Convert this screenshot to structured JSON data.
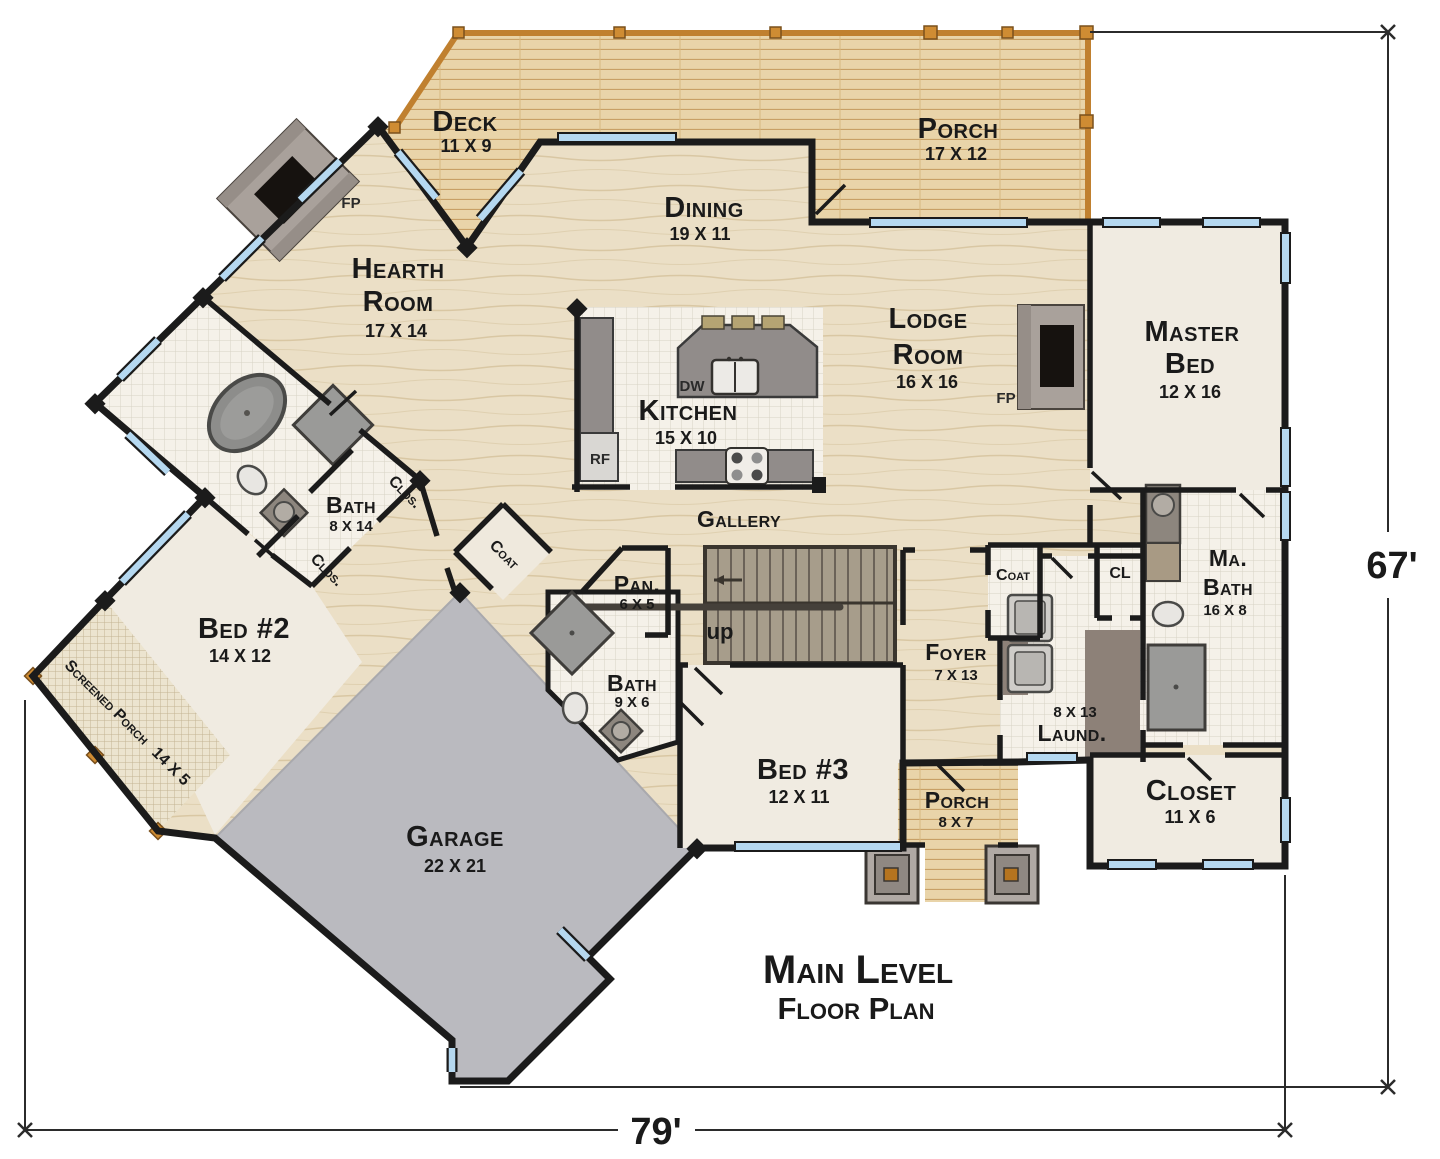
{
  "plan": {
    "title": {
      "line1": "Main Level",
      "line2": "Floor Plan"
    },
    "dimensions": {
      "width": "79'",
      "height": "67'"
    },
    "rooms": {
      "deck": {
        "name": "Deck",
        "size": "11 X 9"
      },
      "porch_top": {
        "name": "Porch",
        "size": "17 X 12"
      },
      "dining": {
        "name": "Dining",
        "size": "19 X 11"
      },
      "hearth": {
        "line1": "Hearth",
        "line2": "Room",
        "size": "17 X 14"
      },
      "lodge": {
        "line1": "Lodge",
        "line2": "Room",
        "size": "16 X 16"
      },
      "master": {
        "line1": "Master",
        "line2": "Bed",
        "size": "12 X 16"
      },
      "kitchen": {
        "name": "Kitchen",
        "size": "15 X 10"
      },
      "bath_main": {
        "name": "Bath",
        "size": "8 X 14"
      },
      "bed2": {
        "name": "Bed #2",
        "size": "14 X 12"
      },
      "screened_porch": {
        "name": "Screened Porch",
        "size": "14 X 5"
      },
      "garage": {
        "name": "Garage",
        "size": "22 X 21"
      },
      "pantry": {
        "name": "Pan.",
        "size": "6 X 5"
      },
      "bath2": {
        "name": "Bath",
        "size": "9 X 6"
      },
      "bed3": {
        "name": "Bed #3",
        "size": "12 X 11"
      },
      "foyer": {
        "name": "Foyer",
        "size": "7 X 13"
      },
      "laundry": {
        "name": "Laund.",
        "size": "8 X 13"
      },
      "master_bath": {
        "line1": "Ma.",
        "line2": "Bath",
        "size": "16 X 8"
      },
      "closet": {
        "name": "Closet",
        "size": "11 X 6"
      },
      "porch_front": {
        "name": "Porch",
        "size": "8 X 7"
      }
    },
    "labels": {
      "gallery": "Gallery",
      "up": "up",
      "coat": "Coat",
      "closet_small": "Clos.",
      "closet_tiny": "CL",
      "fireplace": "FP",
      "dishwasher": "DW",
      "refrigerator": "RF"
    },
    "colors": {
      "wall": "#1b1b1b",
      "window": "#b5d8f0",
      "deck_rail": "#c0802f",
      "wood_floor": "#ebdfc6",
      "deck_floor": "#e9d4a9",
      "tile_floor": "#f5f1e9",
      "room_floor": "#f0ebe1",
      "garage_floor": "#bababf",
      "fixture_gray": "#9a948e"
    }
  }
}
